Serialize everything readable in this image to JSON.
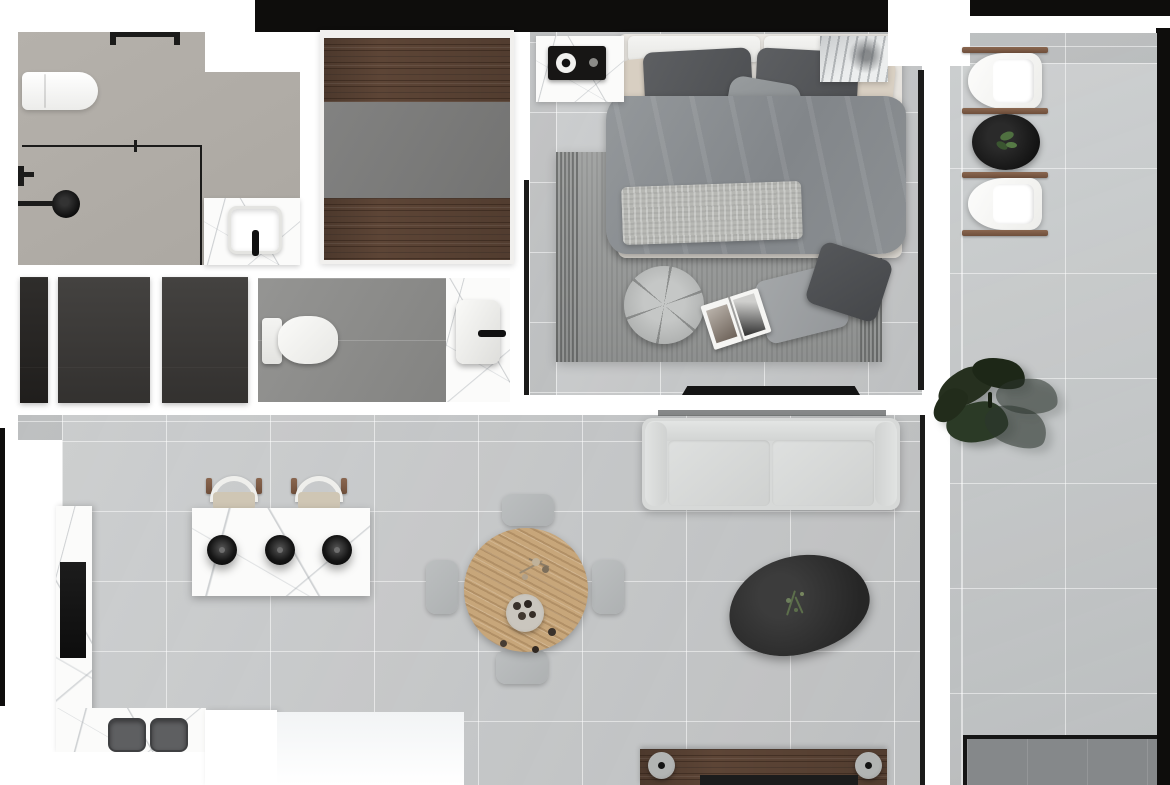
{
  "meta": {
    "title": "Apartment floor plan — top-down 3D render",
    "view": "top-down",
    "render_style": "photorealistic plan"
  },
  "palette": {
    "wall_black": "#0e0d0c",
    "floor_tile": "#c7c9ca",
    "floor_balcony": "#c6c9ca",
    "floor_bath": "#b5b1ab",
    "floor_wc": "#8e8e8c",
    "panel_dark": "#3a3836",
    "panel_darker": "#242220",
    "wood_dark": "#5d4536",
    "wood_oak": "#c7a67a",
    "marble": "#fbfbfa",
    "rug": "#9c9e9d",
    "duvet_gray": "#8a8e91",
    "throw_gray": "#b7b8b4",
    "pillow_dark": "#56585b",
    "pillow_beige": "#d8cfc2",
    "sofa_gray": "#d7d9d8",
    "stone_black": "#2e2e2e",
    "leaf_green": "#2a3523",
    "seat_beige": "#cfc6b4",
    "sink_gray": "#5e5f61",
    "mat_gray": "#85888a"
  },
  "rooms": {
    "bathroom": {
      "label": "Bathroom",
      "items": {
        "toilet": "Wall-hung toilet",
        "shower_screen": "Glass shower screen",
        "shower_head": "Rain shower head",
        "mixer": "Wall shower mixer",
        "filler": "Floor-mounted filler",
        "vanity": "Marble vanity counter",
        "basin": "Square basin",
        "faucet": "Black basin faucet",
        "door_threshold": "Door threshold"
      }
    },
    "wardrobe": {
      "label": "Walk-in wardrobe",
      "items": {
        "upper_shelf": "Upper wooden shelf",
        "interior": "Gray wardrobe interior",
        "lower_shelf": "Lower wooden shelf"
      }
    },
    "bedroom": {
      "label": "Bedroom",
      "items": {
        "rug": "Ribbed area rug",
        "bed": "Double bed",
        "headboard": "Upholstered headboard cushions",
        "pillow_dark_left": "Dark gray pillow",
        "pillow_dark_right": "Dark gray pillow",
        "pillow_beige_left": "Beige pillow",
        "pillow_beige_right": "Beige pillow",
        "pillow_center": "Gray accent pillow",
        "duvet": "Gray duvet",
        "throw": "Knitted throw blanket",
        "nightstand_left": "Marble nightstand",
        "radio": "Black bedside radio",
        "nightstand_right": "Marble nightstand with art print",
        "pouf": "Round tufted pouf",
        "floor_cushion_light": "Light floor cushion",
        "floor_cushion_dark": "Dark floor cushion",
        "magazine": "Open magazine",
        "tv": "Wall-mounted TV",
        "window": "Window wall"
      }
    },
    "wc": {
      "label": "Guest WC",
      "items": {
        "storage_panel_narrow": "Narrow dark panel",
        "storage_panel_left": "Dark storage panel",
        "storage_panel_right": "Dark storage panel",
        "toilet": "Toilet",
        "vanity": "Marble washbasin counter",
        "basin": "Washbasin",
        "faucet": "Black faucet"
      }
    },
    "kitchen": {
      "label": "Kitchen",
      "items": {
        "island": "Marble kitchen island",
        "pendant_lamps": "Black pendant lamp",
        "bar_stool": "Bar stool",
        "tall_counter": "Marble counter run",
        "cooktop": "Black built-in cooktop",
        "base_counter": "Marble base counter",
        "double_sink": "Double undermount sink"
      }
    },
    "dining": {
      "label": "Dining area",
      "items": {
        "table": "Round oak dining table",
        "chair": "Gray dining chair",
        "fruit_bowl": "Bowl with dark fruit",
        "dried_flowers": "Dried flower sprig"
      }
    },
    "living": {
      "label": "Living area",
      "items": {
        "sofa": "Two-seat fabric sofa",
        "coffee_table": "Organic black coffee table",
        "sprig": "Green sprig decor",
        "media_bench": "Wooden media bench",
        "bolster": "Round bench bolster",
        "window": "Window wall"
      }
    },
    "balcony": {
      "label": "Balcony",
      "items": {
        "lounge_chair_top": "Outdoor lounge chair",
        "lounge_chair_bottom": "Outdoor lounge chair",
        "side_table": "Black side table with plant",
        "plant": "Large potted plant",
        "outdoor_mat": "Dark outdoor mat"
      }
    }
  }
}
